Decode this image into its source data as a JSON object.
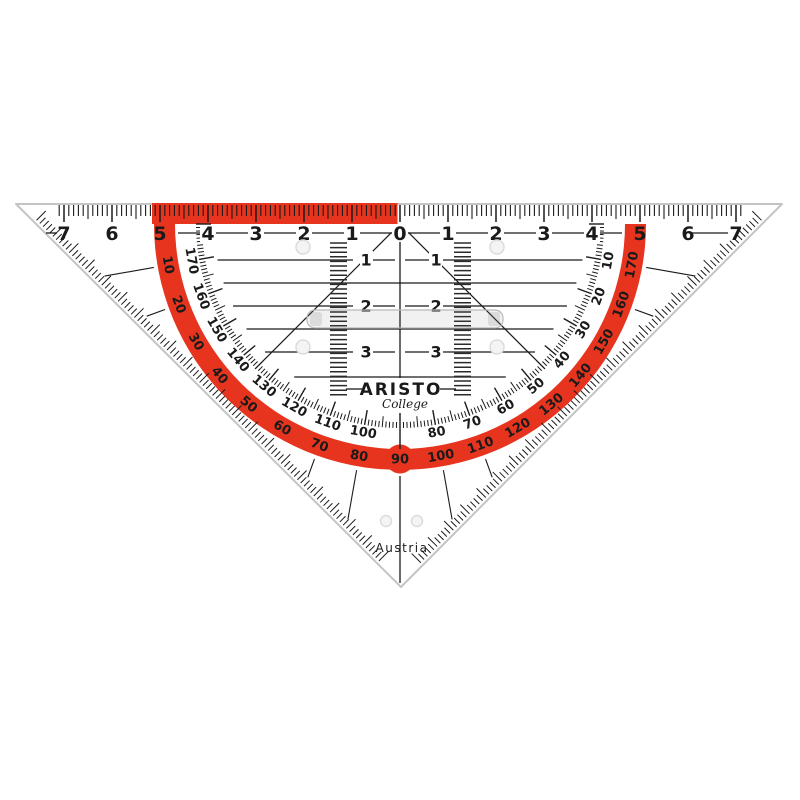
{
  "brand": {
    "name": "ARISTO",
    "series": "College",
    "origin": "Austria"
  },
  "colors": {
    "band_red": "#e6341e",
    "ink": "#1a1a1a",
    "edge": "#c4c4c4"
  },
  "ruler_cm": {
    "numbers": [
      "7",
      "6",
      "5",
      "4",
      "3",
      "2",
      "1",
      "0",
      "1",
      "2",
      "3",
      "4",
      "5",
      "6",
      "7"
    ]
  },
  "parallel_rows": {
    "labels": [
      "1",
      "2",
      "3"
    ]
  },
  "protractor": {
    "outer_scale_deg": [
      10,
      20,
      30,
      40,
      50,
      60,
      70,
      80,
      90,
      100,
      110,
      120,
      130,
      140,
      150,
      160,
      170
    ],
    "bump_label": "90",
    "inner_scale_deg": [
      170,
      160,
      150,
      140,
      130,
      120,
      110,
      100,
      80,
      70,
      60,
      50,
      40,
      30,
      20,
      10
    ]
  }
}
